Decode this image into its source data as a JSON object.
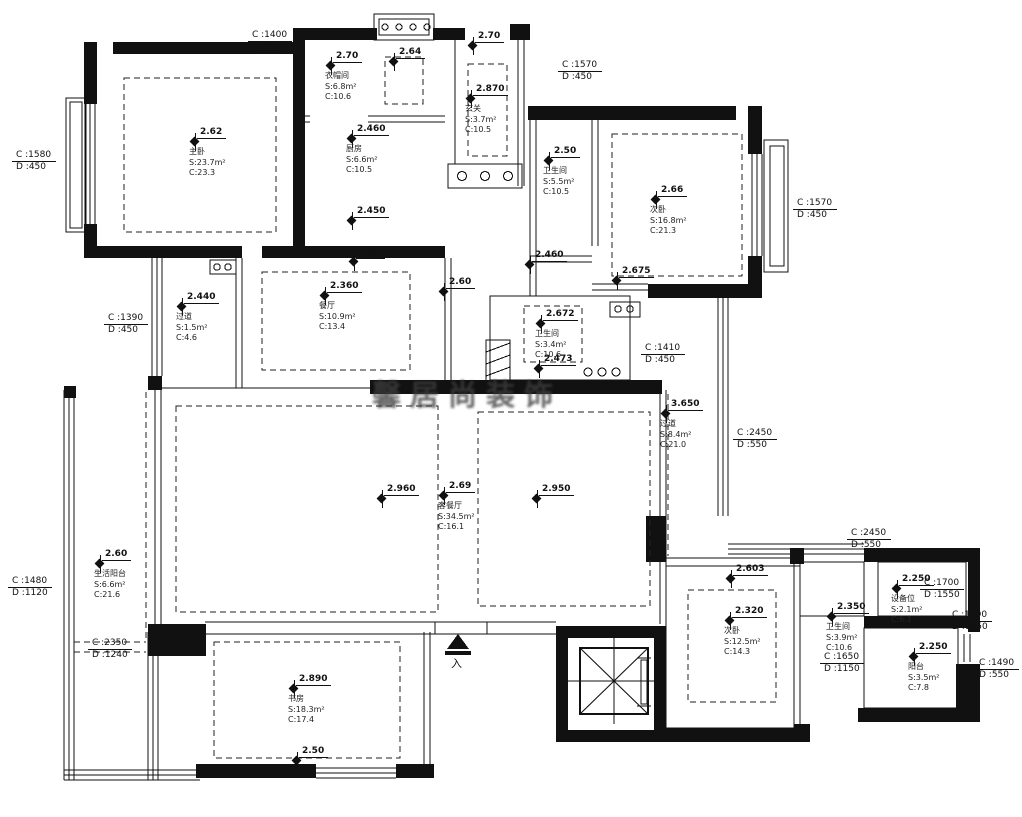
{
  "watermark": {
    "text": "馨居尚装饰"
  },
  "entry": {
    "label": "入"
  },
  "markers": [
    {
      "x": 195,
      "y": 142,
      "elev": "2.62",
      "lines": [
        "主卧",
        "S:23.7m²",
        "C:23.3"
      ]
    },
    {
      "x": 331,
      "y": 66,
      "elev": "2.70",
      "lines": [
        "衣帽间",
        "S:6.8m²",
        "C:10.6"
      ]
    },
    {
      "x": 394,
      "y": 62,
      "elev": "2.64",
      "lines": []
    },
    {
      "x": 352,
      "y": 139,
      "elev": "2.460",
      "lines": [
        "厨房",
        "S:6.6m²",
        "C:10.5"
      ]
    },
    {
      "x": 352,
      "y": 221,
      "elev": "2.450",
      "lines": []
    },
    {
      "x": 354,
      "y": 262,
      "elev": "2.65",
      "lines": []
    },
    {
      "x": 473,
      "y": 46,
      "elev": "2.70",
      "lines": []
    },
    {
      "x": 471,
      "y": 99,
      "elev": "2.870",
      "lines": [
        "玄关",
        "S:3.7m²",
        "C:10.5"
      ]
    },
    {
      "x": 549,
      "y": 161,
      "elev": "2.50",
      "lines": [
        "卫生间",
        "S:5.5m²",
        "C:10.5"
      ]
    },
    {
      "x": 656,
      "y": 200,
      "elev": "2.66",
      "lines": [
        "次卧",
        "S:16.8m²",
        "C:21.3"
      ]
    },
    {
      "x": 530,
      "y": 265,
      "elev": "2.460",
      "lines": []
    },
    {
      "x": 617,
      "y": 281,
      "elev": "2.675",
      "lines": []
    },
    {
      "x": 444,
      "y": 292,
      "elev": "2.60",
      "lines": []
    },
    {
      "x": 541,
      "y": 324,
      "elev": "2.672",
      "lines": [
        "卫生间",
        "S:3.4m²",
        "C:10.6"
      ]
    },
    {
      "x": 539,
      "y": 369,
      "elev": "2.473",
      "lines": []
    },
    {
      "x": 182,
      "y": 307,
      "elev": "2.440",
      "lines": [
        "过道",
        "S:1.5m²",
        "C:4.6"
      ]
    },
    {
      "x": 325,
      "y": 296,
      "elev": "2.360",
      "lines": [
        "餐厅",
        "S:10.9m²",
        "C:13.4"
      ]
    },
    {
      "x": 666,
      "y": 414,
      "elev": "3.650",
      "lines": [
        "过道",
        "S:8.4m²",
        "C:21.0"
      ]
    },
    {
      "x": 382,
      "y": 499,
      "elev": "2.960",
      "lines": []
    },
    {
      "x": 444,
      "y": 496,
      "elev": "2.69",
      "lines": [
        "客餐厅",
        "S:34.5m²",
        "C:16.1"
      ]
    },
    {
      "x": 537,
      "y": 499,
      "elev": "2.950",
      "lines": []
    },
    {
      "x": 100,
      "y": 564,
      "elev": "2.60",
      "lines": [
        "生活阳台",
        "S:6.6m²",
        "C:21.6"
      ]
    },
    {
      "x": 294,
      "y": 689,
      "elev": "2.890",
      "lines": [
        "书房",
        "S:18.3m²",
        "C:17.4"
      ]
    },
    {
      "x": 297,
      "y": 761,
      "elev": "2.50",
      "lines": []
    },
    {
      "x": 731,
      "y": 579,
      "elev": "2.603",
      "lines": []
    },
    {
      "x": 730,
      "y": 621,
      "elev": "2.320",
      "lines": [
        "次卧",
        "S:12.5m²",
        "C:14.3"
      ]
    },
    {
      "x": 832,
      "y": 617,
      "elev": "2.350",
      "lines": [
        "卫生间",
        "S:3.9m²",
        "C:10.6"
      ]
    },
    {
      "x": 897,
      "y": 589,
      "elev": "2.250",
      "lines": [
        "设备位",
        "S:2.1m²",
        "C:6.1"
      ]
    },
    {
      "x": 914,
      "y": 657,
      "elev": "2.250",
      "lines": [
        "阳台",
        "S:3.5m²",
        "C:7.8"
      ]
    }
  ],
  "window_tags": [
    {
      "x": 248,
      "y": 30,
      "c": "C :1400",
      "d": "D :910"
    },
    {
      "x": 558,
      "y": 60,
      "c": "C :1570",
      "d": "D :450"
    },
    {
      "x": 12,
      "y": 150,
      "c": "C :1580",
      "d": "D :450"
    },
    {
      "x": 793,
      "y": 198,
      "c": "C :1570",
      "d": "D :450"
    },
    {
      "x": 104,
      "y": 313,
      "c": "C :1390",
      "d": "D :450"
    },
    {
      "x": 641,
      "y": 343,
      "c": "C :1410",
      "d": "D :450"
    },
    {
      "x": 733,
      "y": 428,
      "c": "C :2450",
      "d": "D :550"
    },
    {
      "x": 847,
      "y": 528,
      "c": "C :2450",
      "d": "D :550"
    },
    {
      "x": 8,
      "y": 576,
      "c": "C :1480",
      "d": "D :1120"
    },
    {
      "x": 88,
      "y": 638,
      "c": "C :2350",
      "d": "D :1240"
    },
    {
      "x": 920,
      "y": 578,
      "c": "C :1700",
      "d": "D :1550"
    },
    {
      "x": 948,
      "y": 610,
      "c": "C :1490",
      "d": "D :1550"
    },
    {
      "x": 820,
      "y": 652,
      "c": "C :1650",
      "d": "D :1150"
    },
    {
      "x": 975,
      "y": 658,
      "c": "C :1490",
      "d": "D :550"
    }
  ]
}
